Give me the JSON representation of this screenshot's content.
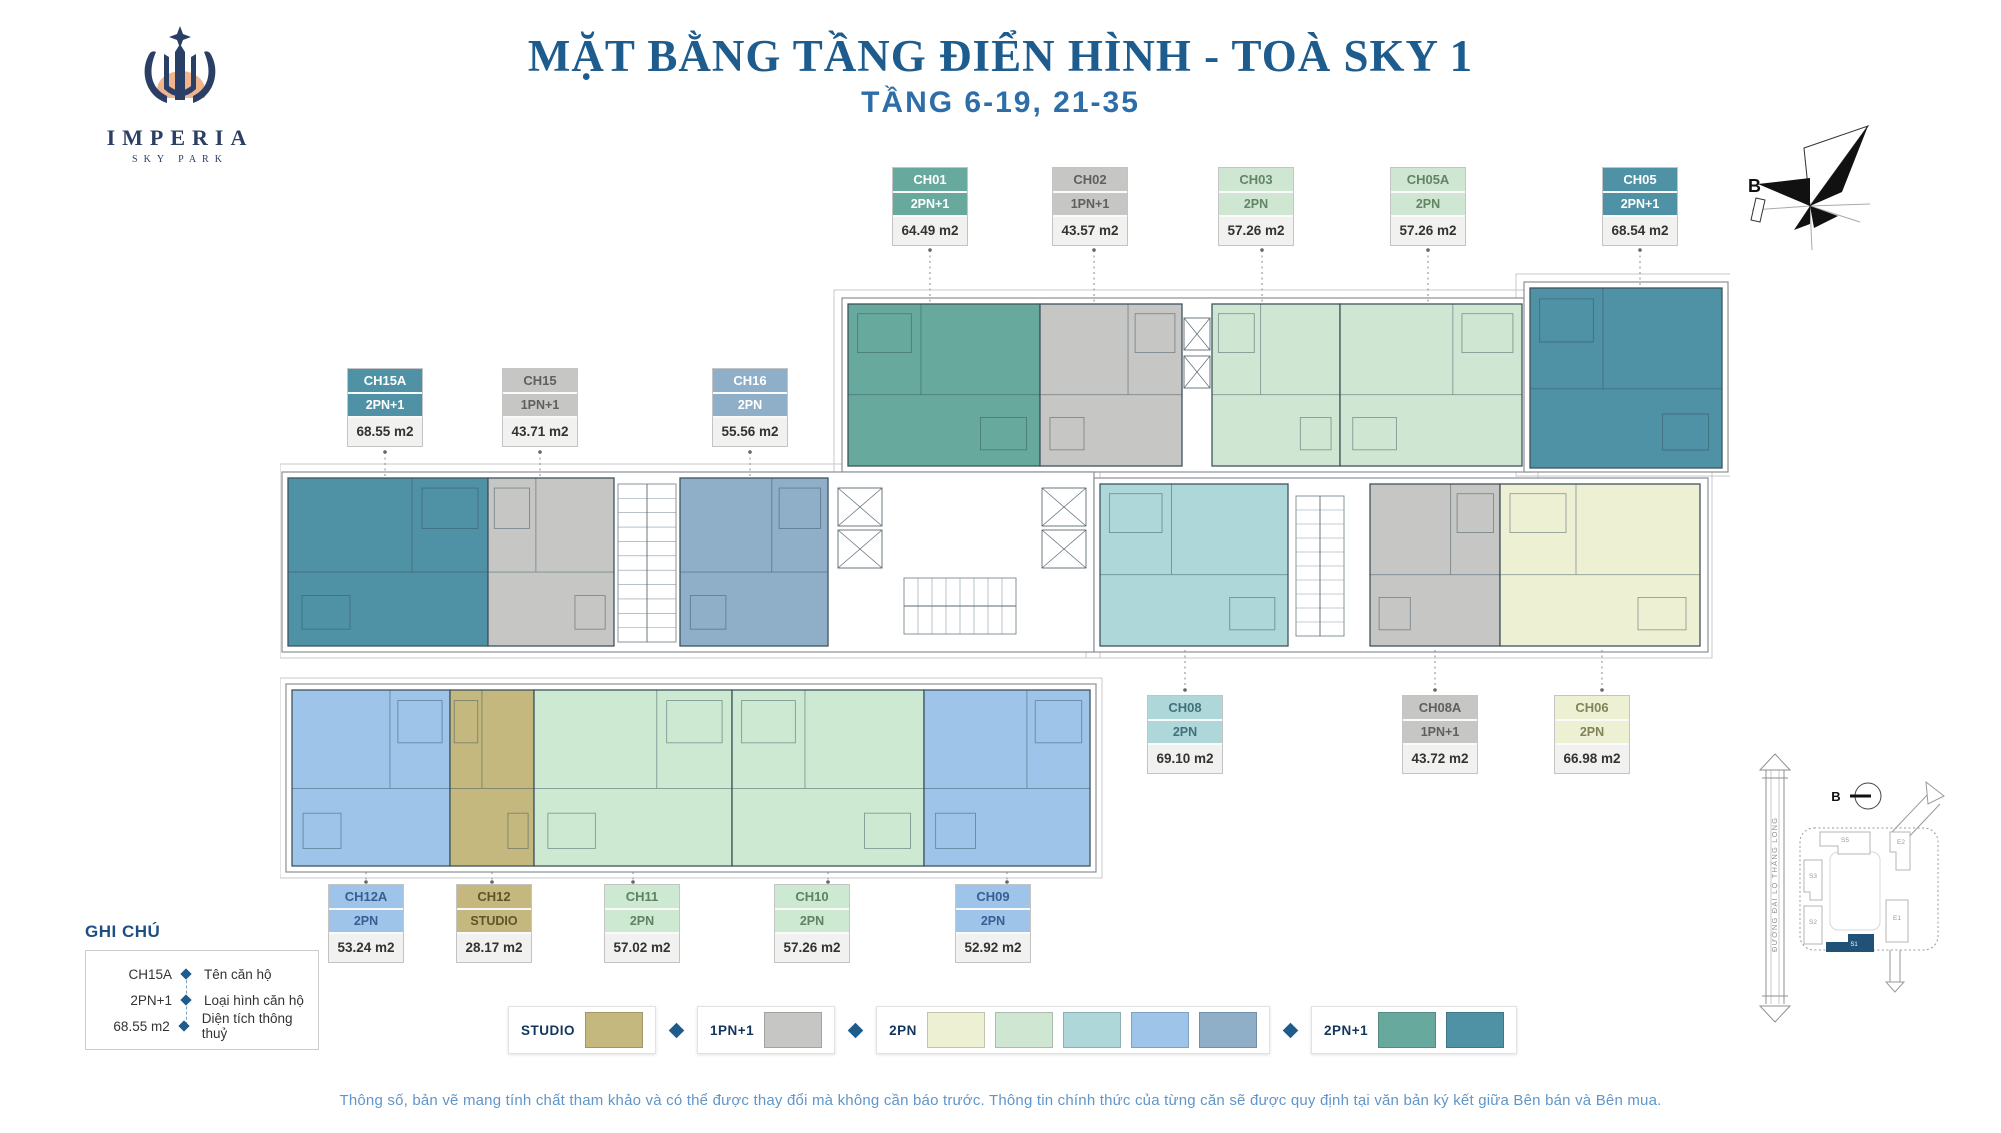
{
  "logo": {
    "brand": "IMPERIA",
    "sub": "SKY PARK"
  },
  "header": {
    "title": "MẶT BẰNG TẦNG ĐIỂN HÌNH - TOÀ SKY 1",
    "subtitle": "TẦNG 6-19, 21-35"
  },
  "compass": {
    "label": "B"
  },
  "units": [
    {
      "code": "CH01",
      "type": "2PN+1",
      "area": "64.49 m2",
      "color": "#68a99e",
      "text_color": "#ffffff"
    },
    {
      "code": "CH02",
      "type": "1PN+1",
      "area": "43.57 m2",
      "color": "#c6c6c4",
      "text_color": "#5f5f5f"
    },
    {
      "code": "CH03",
      "type": "2PN",
      "area": "57.26 m2",
      "color": "#cfe7d2",
      "text_color": "#628565"
    },
    {
      "code": "CH05A",
      "type": "2PN",
      "area": "57.26 m2",
      "color": "#cfe7d2",
      "text_color": "#628565"
    },
    {
      "code": "CH05",
      "type": "2PN+1",
      "area": "68.54 m2",
      "color": "#4f92a6",
      "text_color": "#ffffff"
    },
    {
      "code": "CH15A",
      "type": "2PN+1",
      "area": "68.55 m2",
      "color": "#4f92a6",
      "text_color": "#ffffff"
    },
    {
      "code": "CH15",
      "type": "1PN+1",
      "area": "43.71 m2",
      "color": "#c6c6c4",
      "text_color": "#5f5f5f"
    },
    {
      "code": "CH16",
      "type": "2PN",
      "area": "55.56 m2",
      "color": "#8fafc9",
      "text_color": "#ffffff"
    },
    {
      "code": "CH08",
      "type": "2PN",
      "area": "69.10 m2",
      "color": "#aed7da",
      "text_color": "#42707b"
    },
    {
      "code": "CH08A",
      "type": "1PN+1",
      "area": "43.72 m2",
      "color": "#c6c6c4",
      "text_color": "#5f5f5f"
    },
    {
      "code": "CH06",
      "type": "2PN",
      "area": "66.98 m2",
      "color": "#eef0d4",
      "text_color": "#83835a"
    },
    {
      "code": "CH12A",
      "type": "2PN",
      "area": "53.24 m2",
      "color": "#9ec4ea",
      "text_color": "#3b5e92"
    },
    {
      "code": "CH12",
      "type": "STUDIO",
      "area": "28.17 m2",
      "color": "#c4b87e",
      "text_color": "#5f5527"
    },
    {
      "code": "CH11",
      "type": "2PN",
      "area": "57.02 m2",
      "color": "#cde9d2",
      "text_color": "#5f8263"
    },
    {
      "code": "CH10",
      "type": "2PN",
      "area": "57.26 m2",
      "color": "#cde9d2",
      "text_color": "#5f8263"
    },
    {
      "code": "CH09",
      "type": "2PN",
      "area": "52.92 m2",
      "color": "#9ec4ea",
      "text_color": "#3b5e92"
    }
  ],
  "ghi_chu": {
    "title": "GHI CHÚ",
    "rows": [
      {
        "value": "CH15A",
        "label": "Tên căn hộ"
      },
      {
        "value": "2PN+1",
        "label": "Loại hình căn hộ"
      },
      {
        "value": "68.55 m2",
        "label": "Diện tích thông thuỷ"
      }
    ]
  },
  "color_legend": {
    "groups": [
      {
        "label": "STUDIO",
        "colors": [
          "#c4b87e"
        ]
      },
      {
        "label": "1PN+1",
        "colors": [
          "#c6c6c4"
        ]
      },
      {
        "label": "2PN",
        "colors": [
          "#eef0d4",
          "#cfe7d2",
          "#aed7da",
          "#9ec4ea",
          "#8fafc9"
        ]
      },
      {
        "label": "2PN+1",
        "colors": [
          "#68a99e",
          "#4f92a6"
        ]
      }
    ],
    "diamond_color": "#1d5c8d"
  },
  "sitemap": {
    "road_label": "ĐƯỜNG ĐẠI LỘ THĂNG LONG",
    "buildings": [
      "S5",
      "E2",
      "S3",
      "S2",
      "E1"
    ],
    "highlight": "S1",
    "highlight_color": "#1f5276",
    "compass_label": "B"
  },
  "disclaimer": "Thông số, bản vẽ mang tính chất tham khảo và có thể được thay đổi mà không cần báo trước. Thông tin chính thức của từng căn sẽ được quy định tại văn bản ký kết giữa Bên bán và Bên mua."
}
